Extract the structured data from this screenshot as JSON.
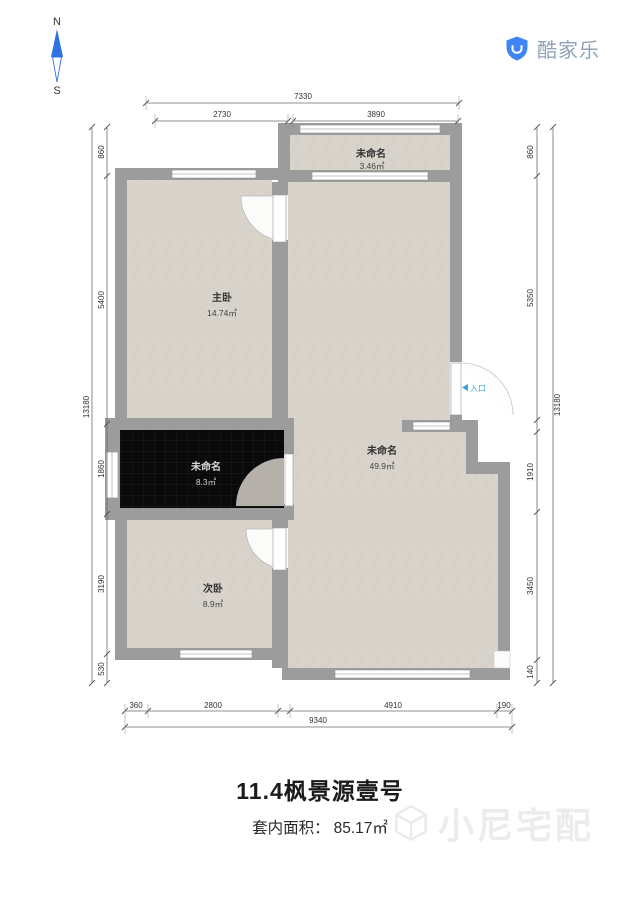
{
  "compass": {
    "north": "N",
    "south": "S"
  },
  "logo": {
    "brand": "酷家乐"
  },
  "plan": {
    "rooms": [
      {
        "id": "balcony",
        "name": "未命名",
        "area": "3.46㎡"
      },
      {
        "id": "master",
        "name": "主卧",
        "area": "14.74㎡"
      },
      {
        "id": "dark",
        "name": "未命名",
        "area": "8.3㎡"
      },
      {
        "id": "living",
        "name": "未命名",
        "area": "49.9㎡"
      },
      {
        "id": "second",
        "name": "次卧",
        "area": "8.9㎡"
      }
    ],
    "entry_label": "入口",
    "dimensions": {
      "top": {
        "overall": "7330",
        "seg1": "2730",
        "seg2": "3890"
      },
      "left": {
        "overall": "13180",
        "seg1": "860",
        "seg2": "5400",
        "seg3": "1860",
        "seg4": "3190",
        "seg5": "530"
      },
      "right": {
        "overall": "13180",
        "seg1": "860",
        "seg2": "5350",
        "seg3": "1910",
        "seg4": "3450",
        "seg5": "140"
      },
      "bottom": {
        "overall": "9340",
        "seg1": "360",
        "seg2": "2800",
        "seg3": "4910",
        "seg4": "190"
      }
    }
  },
  "footer": {
    "title": "11.4枫景源壹号",
    "area_label": "套内面积：",
    "area_value": "85.17㎡",
    "watermark": "小尼宅配"
  },
  "colors": {
    "wall": "#9c9c9c",
    "floor": "#d8d3cb",
    "dark_room": "#0a0a0a",
    "logo_blue": "#3f86f5",
    "entry_blue": "#35a3dc",
    "compass_blue": "#2f72e4"
  }
}
